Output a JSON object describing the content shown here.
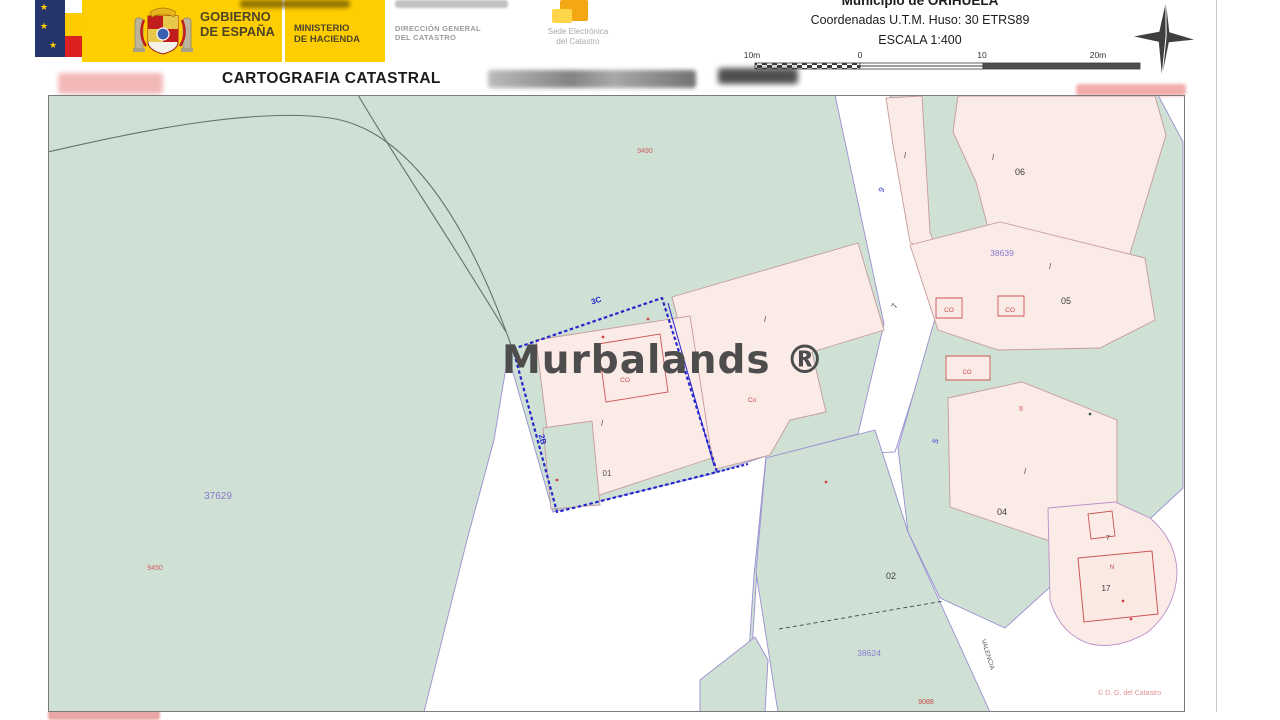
{
  "header": {
    "gobierno_line1": "GOBIERNO",
    "gobierno_line2": "DE ESPAÑA",
    "ministerio_line1": "MINISTERIO",
    "ministerio_line2": "DE HACIENDA",
    "direccion_line1": "DIRECCIÓN GENERAL",
    "direccion_line2": "DEL CATASTRO",
    "sede_line1": "Sede Electrónica",
    "sede_line2": "del Catastro",
    "title": "CARTOGRAFIA CATASTRAL",
    "municipio": "Municipio de ORIHUELA",
    "coordenadas": "Coordenadas U.T.M. Huso: 30 ETRS89",
    "escala": "ESCALA 1:400"
  },
  "scalebar": {
    "ticks": [
      "10m",
      "0",
      "10",
      "20m"
    ]
  },
  "watermark": {
    "text": "Murbalands ®"
  },
  "map": {
    "attribution": "© D. G. del Catastro",
    "colors": {
      "parcel_green": "#cfe1d4",
      "building_pink": "#fbebe7",
      "selected_parcel_blue": "#2626cc",
      "street_edge_purple": "#9a8fd0",
      "building_edge": "#c69a9a",
      "reference_purple": "#8a7ad0",
      "red_label": "#c84848"
    },
    "labels": [
      {
        "t": "37629",
        "x": 218,
        "y": 499,
        "c": "#8a7ad0",
        "s": 10
      },
      {
        "t": "38639",
        "x": 1002,
        "y": 256,
        "c": "#8a7ad0",
        "s": 8.5
      },
      {
        "t": "38624",
        "x": 869,
        "y": 656,
        "c": "#8a7ad0",
        "s": 8.5
      },
      {
        "t": "06",
        "x": 1020,
        "y": 175,
        "c": "#3a3a3a",
        "s": 9
      },
      {
        "t": "05",
        "x": 1066,
        "y": 304,
        "c": "#3a3a3a",
        "s": 9
      },
      {
        "t": "04",
        "x": 1002,
        "y": 515,
        "c": "#3a3a3a",
        "s": 9
      },
      {
        "t": "02",
        "x": 891,
        "y": 579,
        "c": "#3a3a3a",
        "s": 9
      },
      {
        "t": "01",
        "x": 607,
        "y": 476,
        "c": "#555555",
        "s": 8
      },
      {
        "t": "17",
        "x": 1106,
        "y": 591,
        "c": "#3a3a3a",
        "s": 8
      },
      {
        "t": "7",
        "x": 1108,
        "y": 540,
        "c": "#3a3a3a",
        "s": 7
      },
      {
        "t": "9490",
        "x": 645,
        "y": 153,
        "c": "#d06060",
        "s": 7
      },
      {
        "t": "9450",
        "x": 155,
        "y": 570,
        "c": "#d06060",
        "s": 7
      },
      {
        "t": "9088",
        "x": 926,
        "y": 704,
        "c": "#c84848",
        "s": 7
      },
      {
        "t": "CO",
        "x": 625,
        "y": 382,
        "c": "#c84848",
        "s": 6.5
      },
      {
        "t": "Co",
        "x": 752,
        "y": 402,
        "c": "#c84848",
        "s": 6.5
      },
      {
        "t": "CO",
        "x": 949,
        "y": 312,
        "c": "#c84848",
        "s": 6.5
      },
      {
        "t": "CO",
        "x": 1010,
        "y": 312,
        "c": "#c84848",
        "s": 6.5
      },
      {
        "t": "CO",
        "x": 967,
        "y": 374,
        "c": "#c84848",
        "s": 6
      },
      {
        "t": "II",
        "x": 1021,
        "y": 411,
        "c": "#c84848",
        "s": 7
      },
      {
        "t": "N",
        "x": 1112,
        "y": 569,
        "c": "#c84848",
        "s": 6
      },
      {
        "t": "I",
        "x": 905,
        "y": 158,
        "c": "#555555",
        "s": 8,
        "i": 1
      },
      {
        "t": "I",
        "x": 993,
        "y": 160,
        "c": "#555555",
        "s": 8,
        "i": 1
      },
      {
        "t": "I",
        "x": 1050,
        "y": 269,
        "c": "#555555",
        "s": 8,
        "i": 1
      },
      {
        "t": "I",
        "x": 765,
        "y": 322,
        "c": "#555555",
        "s": 8,
        "i": 1
      },
      {
        "t": "I",
        "x": 602,
        "y": 426,
        "c": "#555555",
        "s": 8,
        "i": 1
      },
      {
        "t": "I",
        "x": 1025,
        "y": 474,
        "c": "#555555",
        "s": 8,
        "i": 1
      },
      {
        "t": "9",
        "x": 884,
        "y": 191,
        "c": "#3b3bd0",
        "s": 8,
        "r": -65
      },
      {
        "t": "7",
        "x": 897,
        "y": 307,
        "c": "#3a3a3a",
        "s": 8,
        "r": -65
      },
      {
        "t": "5",
        "x": 938,
        "y": 442,
        "c": "#3b3bd0",
        "s": 8,
        "r": -70
      },
      {
        "t": "3C",
        "x": 597,
        "y": 303,
        "c": "#2626cc",
        "s": 8,
        "r": -18,
        "b": 1
      },
      {
        "t": "2B",
        "x": 540,
        "y": 440,
        "c": "#2626cc",
        "s": 8,
        "r": 76,
        "b": 1
      },
      {
        "t": "VALENCIA",
        "x": 986,
        "y": 655,
        "c": "#5a5a5a",
        "s": 6.5,
        "r": 73
      }
    ],
    "dots": [
      {
        "x": 603,
        "y": 337
      },
      {
        "x": 557,
        "y": 480
      },
      {
        "x": 826,
        "y": 482
      },
      {
        "x": 648,
        "y": 319
      },
      {
        "x": 1123,
        "y": 601
      },
      {
        "x": 1131,
        "y": 619
      },
      {
        "x": 1090,
        "y": 414,
        "c": "#44544a"
      }
    ]
  }
}
